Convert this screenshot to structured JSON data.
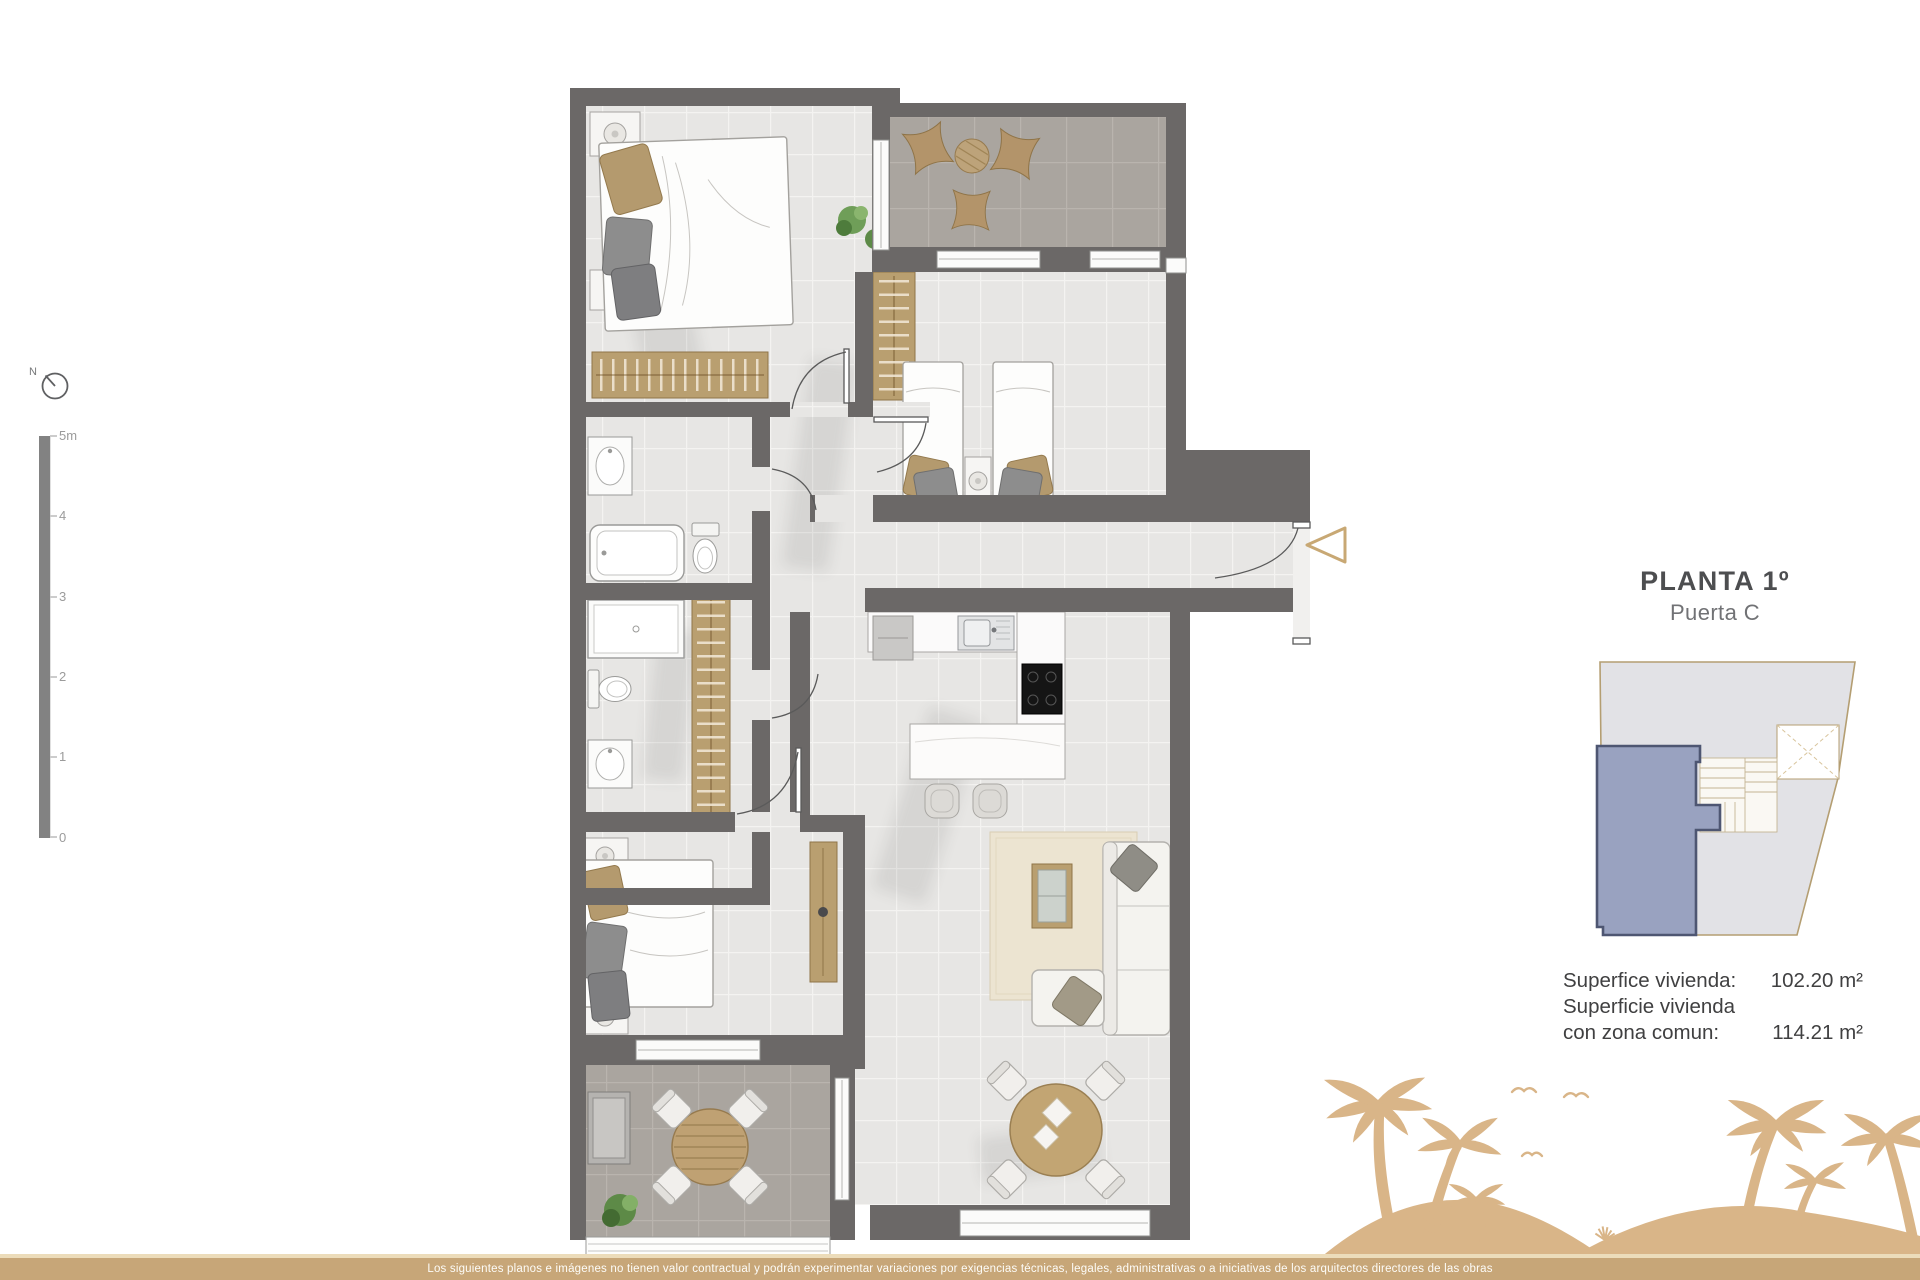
{
  "panel": {
    "title": "PLANTA 1º",
    "subtitle": "Puerta C",
    "areas": [
      {
        "label": "Superfice vivienda:",
        "value": "102.20 m²"
      },
      {
        "label": "Superficie vivienda con zona comun:",
        "value": "114.21 m²"
      }
    ]
  },
  "compass": {
    "label": "N"
  },
  "scale_bar": {
    "labels": [
      "5m",
      "4",
      "3",
      "2",
      "1",
      "0"
    ]
  },
  "footer": {
    "disclaimer": "Los siguientes planos e imágenes no tienen valor contractual y podrán experimentar variaciones por exigencias técnicas, legales, administrativas o a iniciativas de los arquitectos directores de las obras"
  },
  "icons": {
    "north_compass": "circle-with-needle",
    "entrance_arrow": "hollow-triangle-left"
  },
  "colors": {
    "wall": "#6b6867",
    "floor_light": "#e7e6e4",
    "floor_terrace": "#aaa59f",
    "wood_accent": "#b99f70",
    "palm_silhouette": "#d9b588",
    "footer_bar": "#c7a678",
    "keyplan_unit_fill": "#99a2c0",
    "keyplan_unit_border": "#4e5672",
    "keyplan_outline": "#b49e72",
    "title_text": "#4d4e50"
  }
}
